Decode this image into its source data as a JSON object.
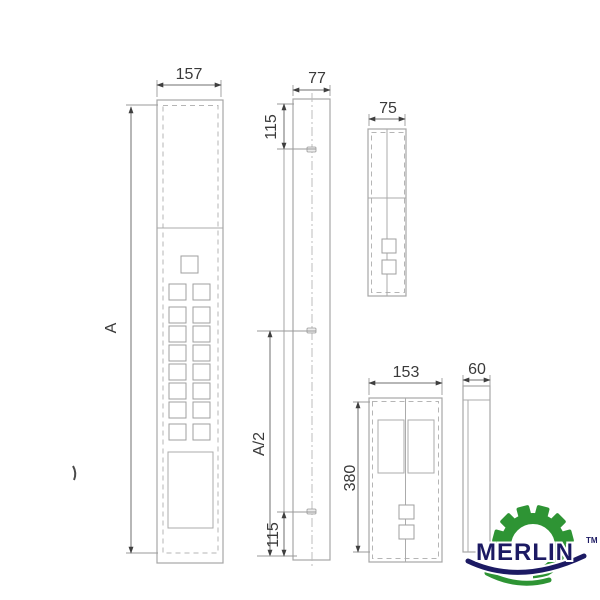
{
  "views": {
    "front": {
      "width_label": "157",
      "height_label": "A"
    },
    "side": {
      "depth_label": "77",
      "top_offset_label": "115",
      "half_height_label": "A/2",
      "bottom_offset_label": "115"
    },
    "aux_panel": {
      "width_label": "75"
    },
    "hall_panel": {
      "width_label": "153",
      "height_label": "380"
    },
    "hall_side": {
      "depth_label": "60"
    }
  },
  "logo": {
    "brand": "MERLIN",
    "trademark": "TM",
    "green": "#2e9434",
    "navy": "#1c1a63"
  },
  "line_colors": {
    "outline": "#a6a6a6",
    "hidden": "#b5b5b5",
    "centerline": "#bdbdbd",
    "dimension": "#6f6f6f",
    "dimension_text": "#3a3a3a"
  }
}
